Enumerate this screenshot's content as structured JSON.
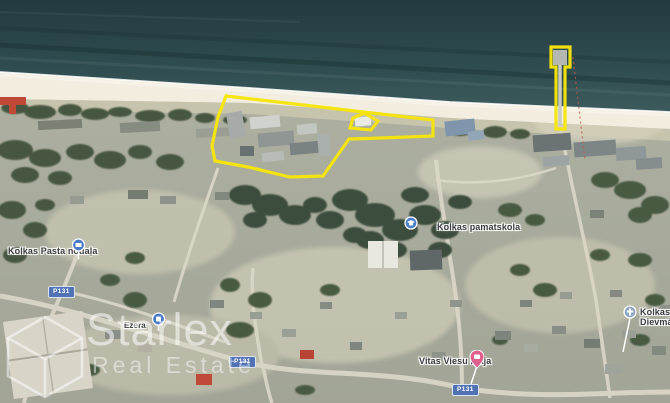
{
  "map": {
    "type": "satellite",
    "labels": [
      {
        "text": "Kolkas Pasta nodaļa"
      },
      {
        "text": "Ezera"
      },
      {
        "text": "Kolkas pamatskola"
      },
      {
        "text": "Vitas Viesu māja"
      },
      {
        "line1": "Kolkas Jū",
        "line2": "Dievmāt"
      }
    ],
    "road_badges": [
      {
        "text": "P131"
      },
      {
        "text": "P131"
      },
      {
        "text": "P131"
      }
    ],
    "watermark": {
      "brand": "Starlex",
      "tagline": "Real Estate"
    },
    "colors": {
      "parcel_outline": "#f6e50b",
      "sea": "#2c484c",
      "sand": "#f2eddf",
      "road_badge": "#5173b4",
      "poi_pin": "#4a79c9",
      "lodging_pin": "#df5f8d",
      "ferry_route_dotted": "#c65848"
    }
  }
}
